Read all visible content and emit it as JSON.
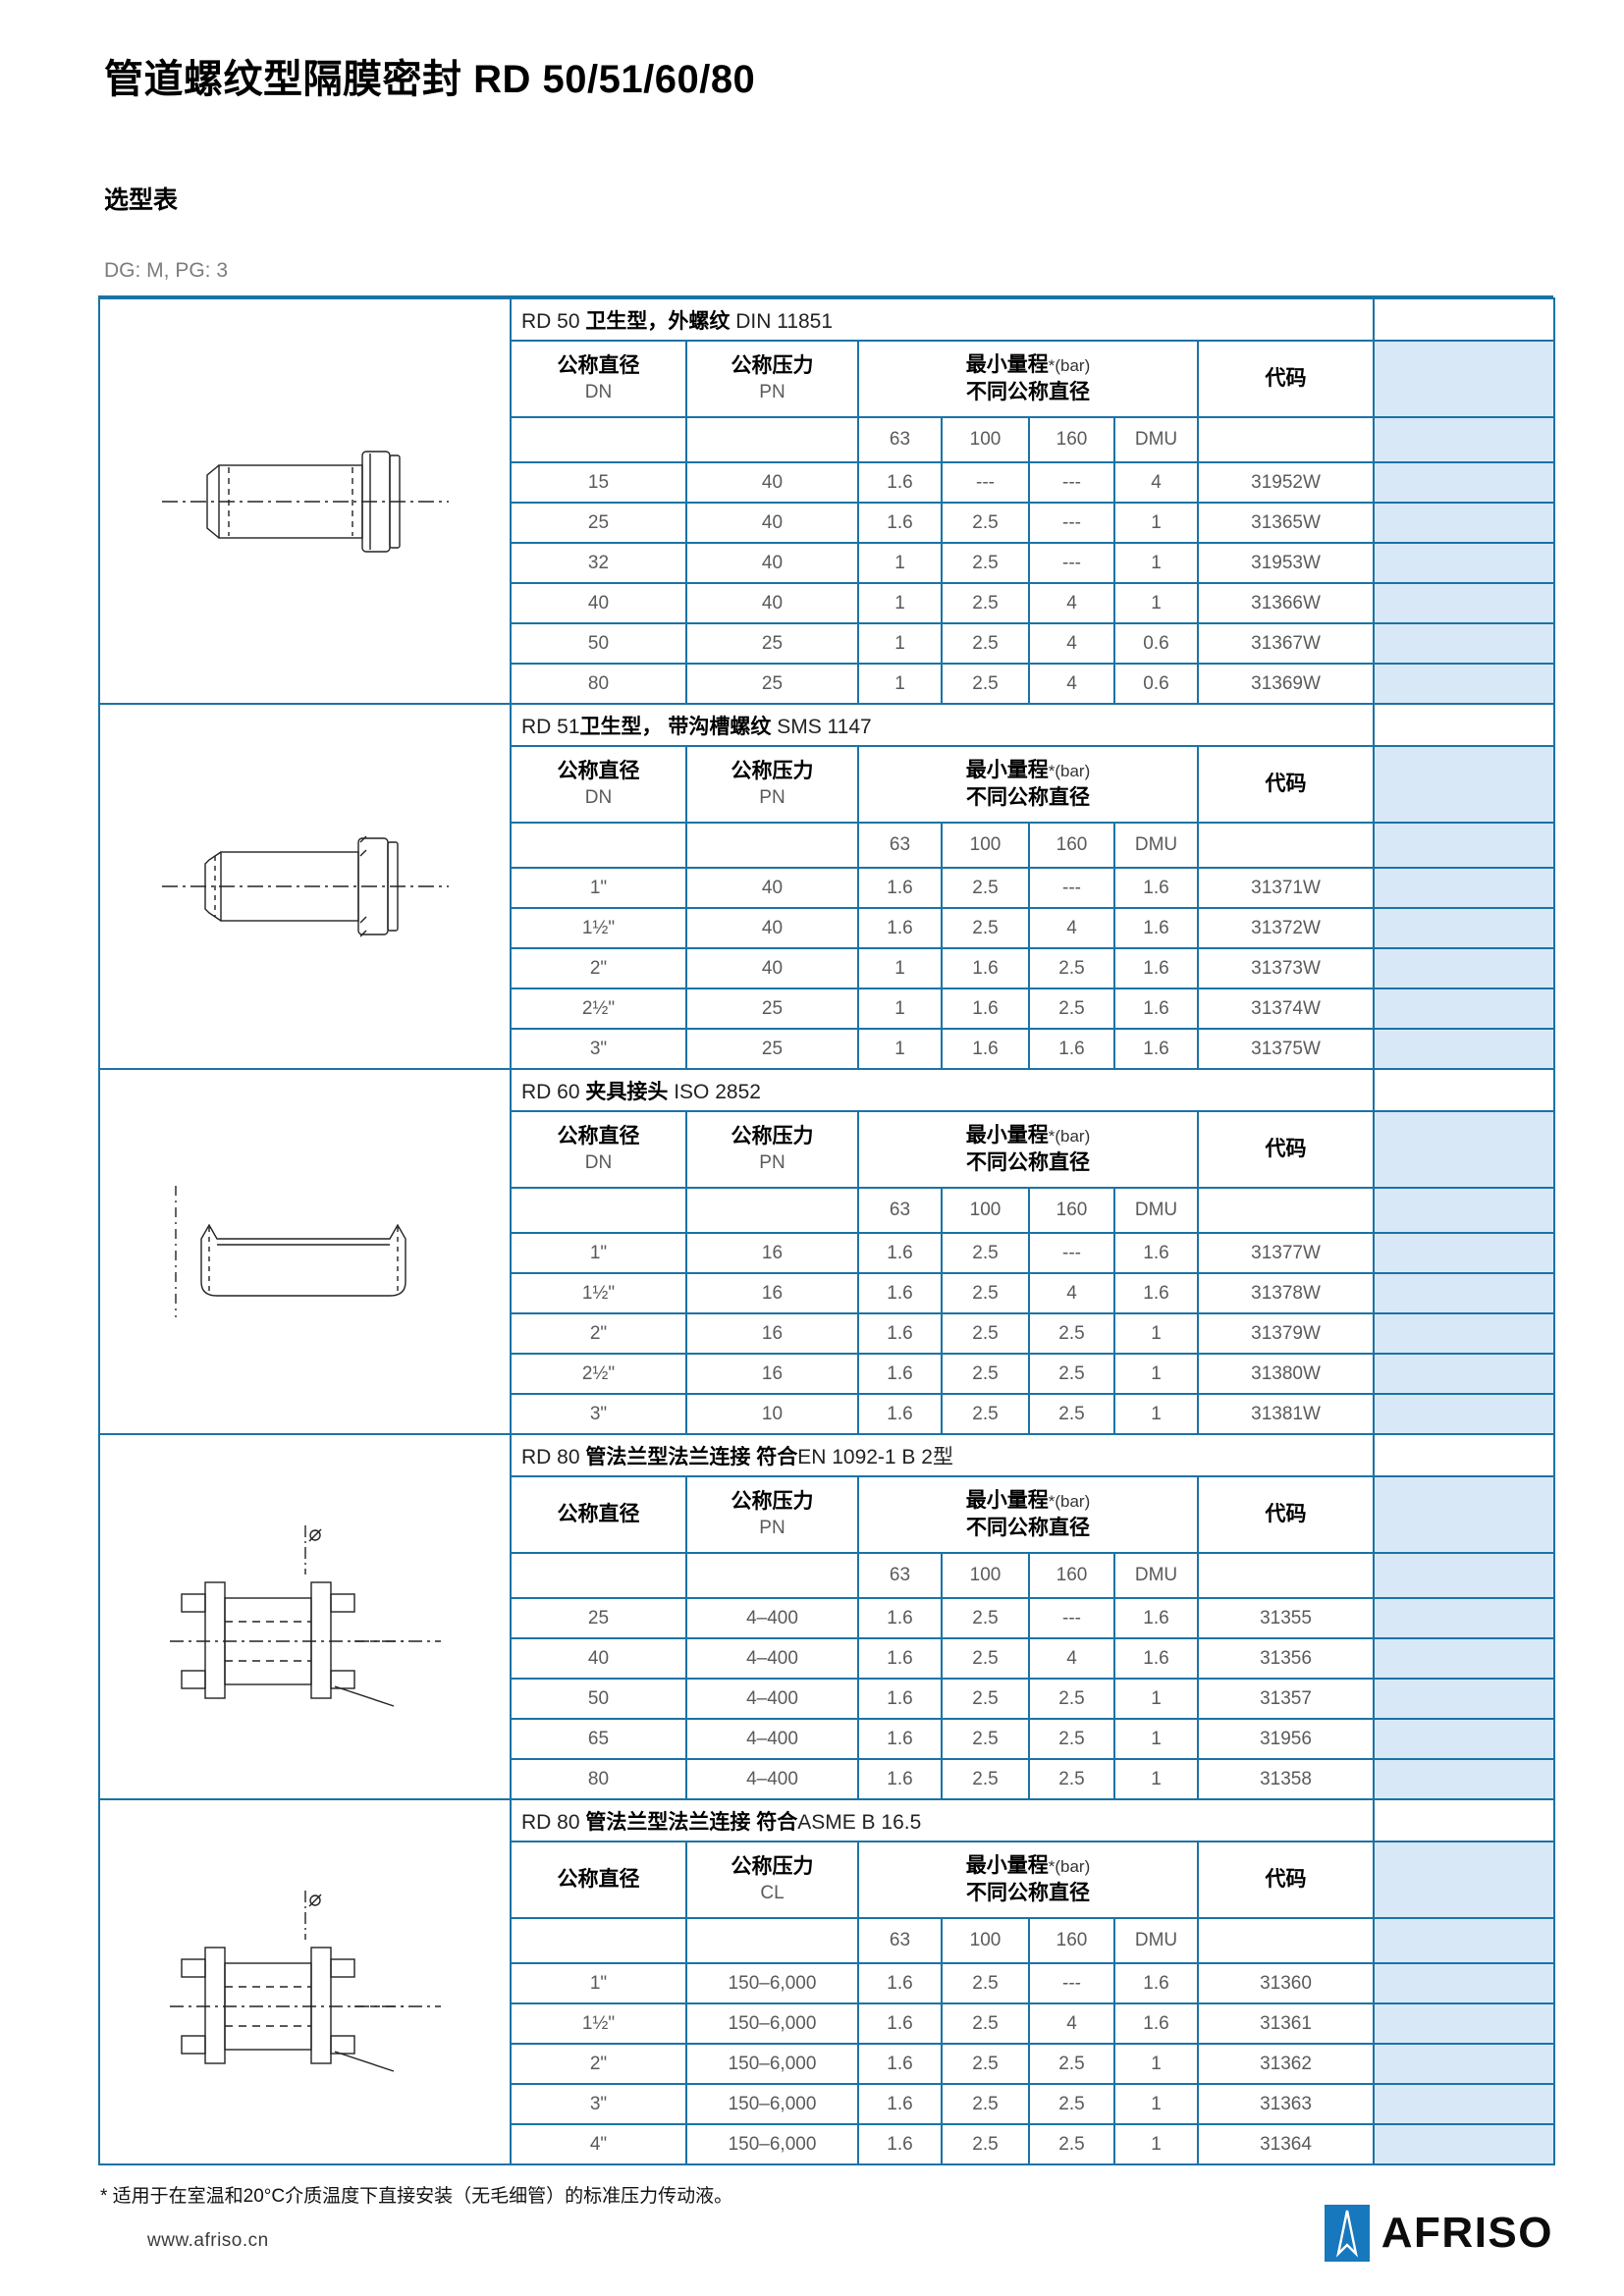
{
  "page": {
    "title": "管道螺纹型隔膜密封 RD 50/51/60/80",
    "subtitle": "选型表",
    "meta": "DG: M, PG: 3",
    "footnote": "* 适用于在室温和20°C介质温度下直接安装（无毛细管）的标准压力传动液。",
    "footer": {
      "url": "www.afriso.cn",
      "brand": "AFRISO"
    }
  },
  "colors": {
    "table_border": "#1a73a6",
    "shaded_column": "#d9e8f6",
    "logo_blue": "#1878be"
  },
  "columns": {
    "dn": "公称直径",
    "pn": "公称压力",
    "range_main": "最小量程",
    "range_note": "*(bar)",
    "range_line2": "不同公称直径",
    "code": "代码",
    "sub": [
      "63",
      "100",
      "160",
      "DMU"
    ]
  },
  "sections": [
    {
      "id": "rd50",
      "drawing": "dw-coupling-din",
      "drawing_name": "rd50-threaded-coupling-drawing",
      "title": [
        {
          "text": "RD 50 ",
          "bold": false
        },
        {
          "text": "卫生型，外螺纹",
          "bold": true
        },
        {
          "text": " DIN 11851",
          "bold": false
        }
      ],
      "dn_sub": "DN",
      "pn_sub": "PN",
      "rows": [
        [
          "15",
          "40",
          "1.6",
          "---",
          "---",
          "4",
          "31952W"
        ],
        [
          "25",
          "40",
          "1.6",
          "2.5",
          "---",
          "1",
          "31365W"
        ],
        [
          "32",
          "40",
          "1",
          "2.5",
          "---",
          "1",
          "31953W"
        ],
        [
          "40",
          "40",
          "1",
          "2.5",
          "4",
          "1",
          "31366W"
        ],
        [
          "50",
          "25",
          "1",
          "2.5",
          "4",
          "0.6",
          "31367W"
        ],
        [
          "80",
          "25",
          "1",
          "2.5",
          "4",
          "0.6",
          "31369W"
        ]
      ]
    },
    {
      "id": "rd51",
      "drawing": "dw-coupling-sms",
      "drawing_name": "rd51-grooved-coupling-drawing",
      "title": [
        {
          "text": "RD 51",
          "bold": false
        },
        {
          "text": "卫生型， 带沟槽螺纹",
          "bold": true
        },
        {
          "text": " SMS 1147",
          "bold": false
        }
      ],
      "dn_sub": "DN",
      "pn_sub": "PN",
      "rows": [
        [
          "1\"",
          "40",
          "1.6",
          "2.5",
          "---",
          "1.6",
          "31371W"
        ],
        [
          "1½\"",
          "40",
          "1.6",
          "2.5",
          "4",
          "1.6",
          "31372W"
        ],
        [
          "2\"",
          "40",
          "1",
          "1.6",
          "2.5",
          "1.6",
          "31373W"
        ],
        [
          "2½\"",
          "25",
          "1",
          "1.6",
          "2.5",
          "1.6",
          "31374W"
        ],
        [
          "3\"",
          "25",
          "1",
          "1.6",
          "1.6",
          "1.6",
          "31375W"
        ]
      ]
    },
    {
      "id": "rd60",
      "drawing": "dw-ferrule",
      "drawing_name": "rd60-clamp-ferrule-drawing",
      "title": [
        {
          "text": "RD 60 ",
          "bold": false
        },
        {
          "text": "夹具接头",
          "bold": true
        },
        {
          "text": " ISO 2852",
          "bold": false
        }
      ],
      "dn_sub": "DN",
      "pn_sub": "PN",
      "rows": [
        [
          "1\"",
          "16",
          "1.6",
          "2.5",
          "---",
          "1.6",
          "31377W"
        ],
        [
          "1½\"",
          "16",
          "1.6",
          "2.5",
          "4",
          "1.6",
          "31378W"
        ],
        [
          "2\"",
          "16",
          "1.6",
          "2.5",
          "2.5",
          "1",
          "31379W"
        ],
        [
          "2½\"",
          "16",
          "1.6",
          "2.5",
          "2.5",
          "1",
          "31380W"
        ],
        [
          "3\"",
          "10",
          "1.6",
          "2.5",
          "2.5",
          "1",
          "31381W"
        ]
      ]
    },
    {
      "id": "rd80-en",
      "drawing": "dw-flange",
      "drawing_name": "rd80-en-flange-drawing",
      "title": [
        {
          "text": "RD 80 ",
          "bold": false
        },
        {
          "text": "管法兰型法兰连接 符合",
          "bold": true
        },
        {
          "text": "EN 1092-1 B 2型",
          "bold": false
        }
      ],
      "dn_sub": "",
      "pn_sub": "PN",
      "rows": [
        [
          "25",
          "4–400",
          "1.6",
          "2.5",
          "---",
          "1.6",
          "31355"
        ],
        [
          "40",
          "4–400",
          "1.6",
          "2.5",
          "4",
          "1.6",
          "31356"
        ],
        [
          "50",
          "4–400",
          "1.6",
          "2.5",
          "2.5",
          "1",
          "31357"
        ],
        [
          "65",
          "4–400",
          "1.6",
          "2.5",
          "2.5",
          "1",
          "31956"
        ],
        [
          "80",
          "4–400",
          "1.6",
          "2.5",
          "2.5",
          "1",
          "31358"
        ]
      ]
    },
    {
      "id": "rd80-asme",
      "drawing": "dw-flange",
      "drawing_name": "rd80-asme-flange-drawing",
      "title": [
        {
          "text": "RD 80 ",
          "bold": false
        },
        {
          "text": "管法兰型法兰连接 符合",
          "bold": true
        },
        {
          "text": "ASME B 16.5",
          "bold": false
        }
      ],
      "dn_sub": "",
      "pn_sub": "CL",
      "rows": [
        [
          "1\"",
          "150–6,000",
          "1.6",
          "2.5",
          "---",
          "1.6",
          "31360"
        ],
        [
          "1½\"",
          "150–6,000",
          "1.6",
          "2.5",
          "4",
          "1.6",
          "31361"
        ],
        [
          "2\"",
          "150–6,000",
          "1.6",
          "2.5",
          "2.5",
          "1",
          "31362"
        ],
        [
          "3\"",
          "150–6,000",
          "1.6",
          "2.5",
          "2.5",
          "1",
          "31363"
        ],
        [
          "4\"",
          "150–6,000",
          "1.6",
          "2.5",
          "2.5",
          "1",
          "31364"
        ]
      ]
    }
  ]
}
